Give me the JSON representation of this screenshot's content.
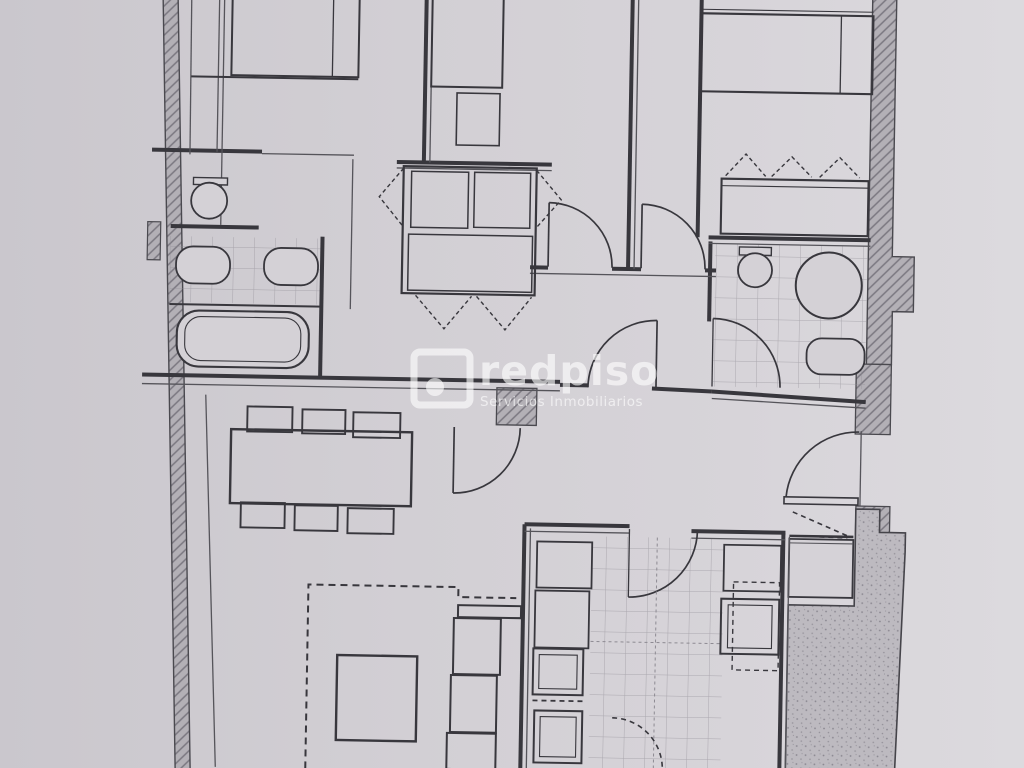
{
  "document": {
    "kind": "scanned-apartment-floor-plan",
    "watermark": {
      "brand": "redpiso",
      "tagline": "Servicios Inmobiliarios"
    }
  },
  "palette": {
    "paper": "#d2cfd4",
    "paper_light": "#dcdade",
    "ink": "#38373d",
    "wall_fill": "#b3b0b6",
    "tile_line": "#8d8a92",
    "terrace_fill": "#bdbac0",
    "watermark": "#ffffff"
  },
  "depicted_elements": [
    "three bedrooms with beds (cropped at top edge)",
    "built-in wardrobes with dashed door-swing marks",
    "left bathroom: toilet, washbasin, bidet, bathtub, tiled floor",
    "en-suite bathroom: toilet, round shower, bidet, tiled floor",
    "corridor and hall with interior door arcs and entry door",
    "living-dining room: table with six chairs, rug, coffee table, sofa",
    "fitted kitchen: counters, appliances, tiled floor, dashed service door",
    "stippled terrace with stepped exterior wall",
    "hatched load-bearing exterior walls"
  ]
}
